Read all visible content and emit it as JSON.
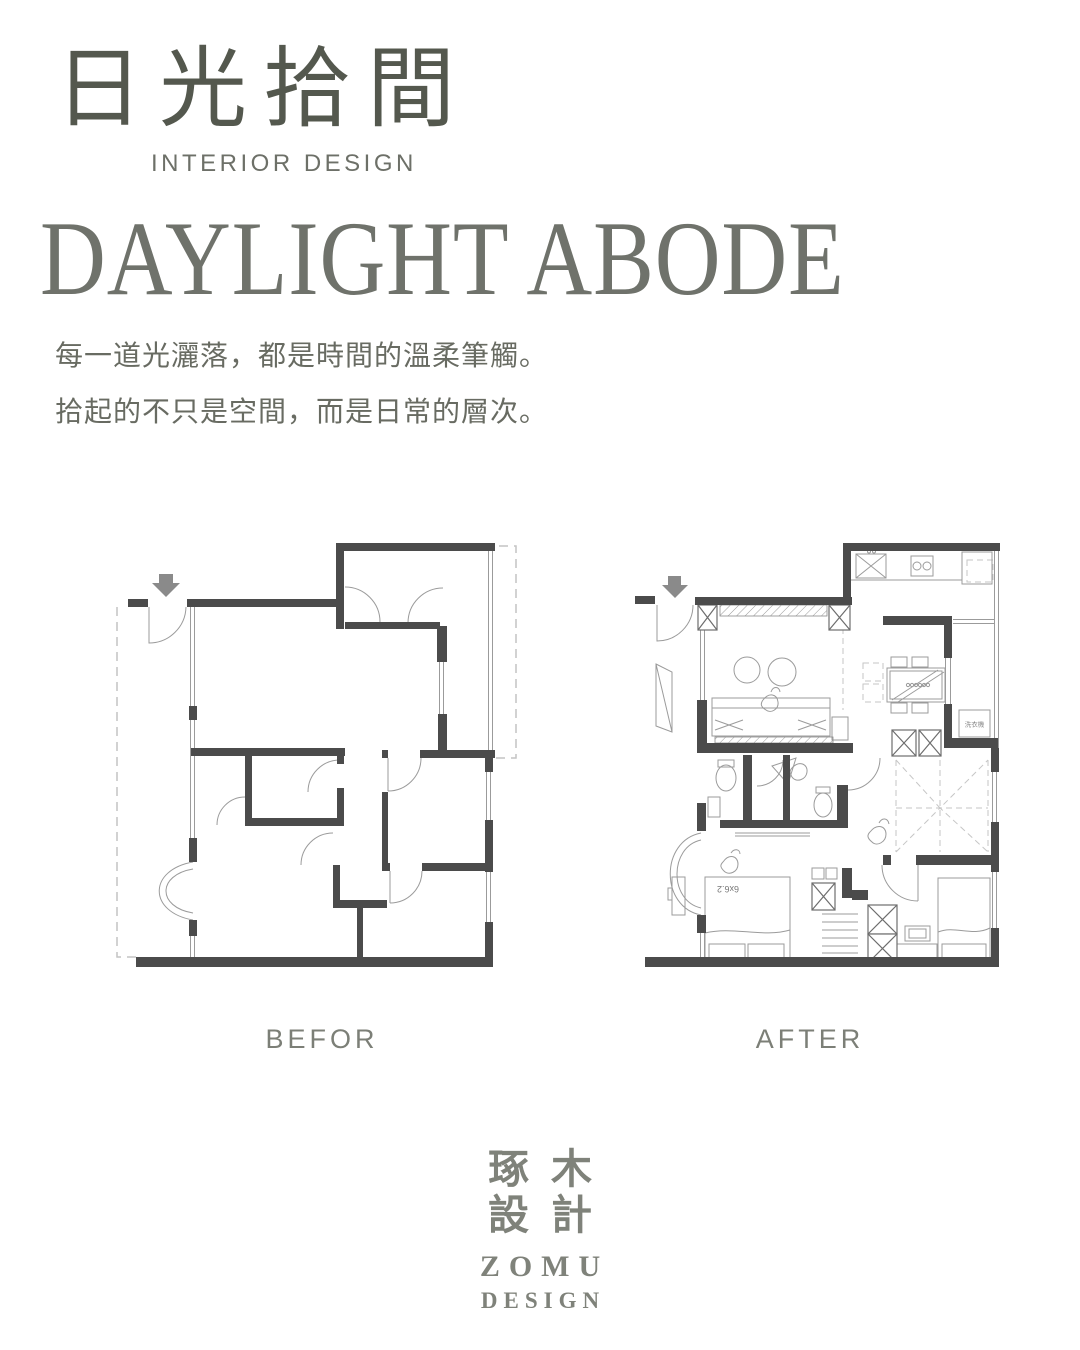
{
  "header": {
    "title_zh": "日光拾間",
    "subtitle_en": "INTERIOR DESIGN",
    "title_en": "DAYLIGHT ABODE",
    "body_line1": "每一道光灑落，都是時間的溫柔筆觸。",
    "body_line2": "拾起的不只是空間，而是日常的層次。"
  },
  "plans": {
    "before_label": "BEFOR",
    "after_label": "AFTER",
    "after_annotations": {
      "washer": "洗衣機",
      "bed_size": "6x6.2"
    }
  },
  "footer": {
    "logo_zh_line1": "琢木",
    "logo_zh_line2": "設計",
    "logo_en_line1": "ZOMU",
    "logo_en_line2": "DESIGN"
  },
  "colors": {
    "title_zh": "#54584E",
    "title_en": "#6F726B",
    "body_text": "#686B62",
    "plan_label": "#7C7F77",
    "wall": "#4B4B4B",
    "thin_line": "#9B9B9B",
    "dashed_line": "#C4C4C4",
    "arrow": "#8A8A8A",
    "logo": "#7F827A",
    "background": "#FFFFFF"
  }
}
